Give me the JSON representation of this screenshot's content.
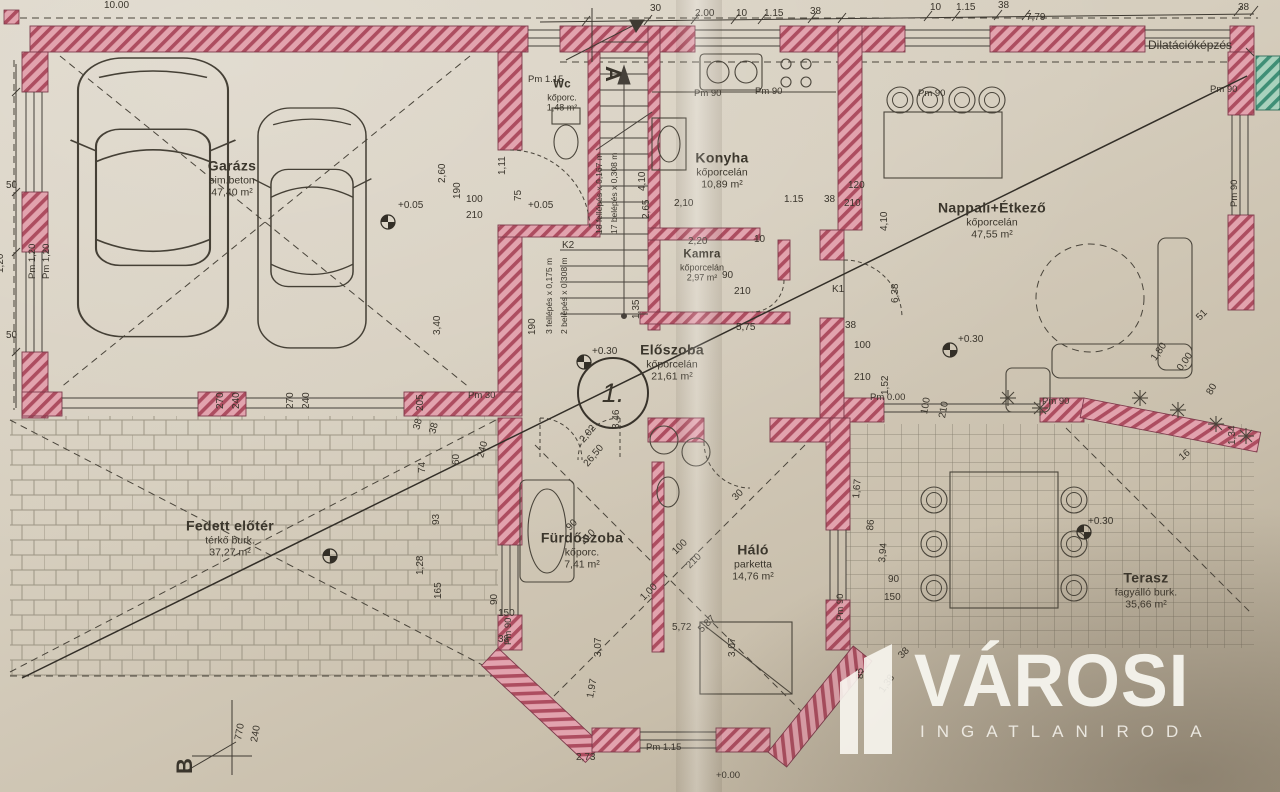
{
  "rooms": [
    {
      "name": "Garázs",
      "finish": "sim.beton",
      "area": "47,40 m²"
    },
    {
      "name": "Wc",
      "finish": "kőporc.",
      "area": "1,48 m²"
    },
    {
      "name": "Konyha",
      "finish": "kőporcelán",
      "area": "10,89 m²"
    },
    {
      "name": "Kamra",
      "finish": "kőporcelán",
      "area": "2,97 m²"
    },
    {
      "name": "Nappali+Étkező",
      "finish": "kőporcelán",
      "area": "47,55 m²"
    },
    {
      "name": "Előszoba",
      "finish": "kőporcelán",
      "area": "21,61 m²"
    },
    {
      "name": "Fürdőszoba",
      "finish": "kőporc.",
      "area": "7,41 m²"
    },
    {
      "name": "Háló",
      "finish": "parketta",
      "area": "14,76 m²"
    },
    {
      "name": "Terasz",
      "finish": "fagyálló burk.",
      "area": "35,66 m²"
    },
    {
      "name": "Fedett előtér",
      "finish": "térkő burk.",
      "area": "37,27 m²"
    }
  ],
  "markers": {
    "circle": "1.",
    "section_a": "A",
    "section_b": "B"
  },
  "watermark": {
    "title": "VÁROSI",
    "subtitle": "INGATLANIRODA"
  },
  "dims": [
    {
      "t": "10.00",
      "x": 104,
      "y": 0
    },
    {
      "t": "30",
      "x": 650,
      "y": 3
    },
    {
      "t": "2.00",
      "x": 695,
      "y": 8
    },
    {
      "t": "10",
      "x": 736,
      "y": 8
    },
    {
      "t": "1.15",
      "x": 764,
      "y": 8
    },
    {
      "t": "38",
      "x": 810,
      "y": 6
    },
    {
      "t": "10",
      "x": 930,
      "y": 2
    },
    {
      "t": "1.15",
      "x": 956,
      "y": 2
    },
    {
      "t": "38",
      "x": 998,
      "y": 0
    },
    {
      "t": "7,79",
      "x": 1026,
      "y": 12
    },
    {
      "t": "38",
      "x": 1238,
      "y": 2
    },
    {
      "t": "Dilatációképzés",
      "x": 1148,
      "y": 38,
      "c": "note"
    },
    {
      "t": "Pm 1.15",
      "x": 528,
      "y": 74,
      "c": "small"
    },
    {
      "t": "Pm 90",
      "x": 694,
      "y": 88,
      "c": "small"
    },
    {
      "t": "Pm 90",
      "x": 755,
      "y": 86,
      "c": "small"
    },
    {
      "t": "Pm 90",
      "x": 918,
      "y": 88,
      "c": "small"
    },
    {
      "t": "Pm 90",
      "x": 1210,
      "y": 84,
      "c": "small"
    },
    {
      "t": "Pm 90",
      "x": 1240,
      "y": 196,
      "r": -90,
      "c": "small"
    },
    {
      "t": "50",
      "x": 6,
      "y": 180
    },
    {
      "t": "Pm 1,20",
      "x": 38,
      "y": 268,
      "r": -90,
      "c": "small"
    },
    {
      "t": "Pm 1,20",
      "x": 52,
      "y": 268,
      "r": -90,
      "c": "small"
    },
    {
      "t": "50",
      "x": 6,
      "y": 330
    },
    {
      "t": "1,20",
      "x": 6,
      "y": 262,
      "r": -90
    },
    {
      "t": "270",
      "x": 226,
      "y": 398,
      "r": -90
    },
    {
      "t": "240",
      "x": 242,
      "y": 398,
      "r": -90
    },
    {
      "t": "270",
      "x": 296,
      "y": 398,
      "r": -90
    },
    {
      "t": "240",
      "x": 312,
      "y": 398,
      "r": -90
    },
    {
      "t": "+0.05",
      "x": 398,
      "y": 200
    },
    {
      "t": "100",
      "x": 466,
      "y": 194
    },
    {
      "t": "210",
      "x": 466,
      "y": 210
    },
    {
      "t": "2,60",
      "x": 448,
      "y": 172,
      "r": -90
    },
    {
      "t": "190",
      "x": 463,
      "y": 188,
      "r": -90
    },
    {
      "t": "3,40",
      "x": 443,
      "y": 324,
      "r": -90
    },
    {
      "t": "205",
      "x": 426,
      "y": 400,
      "r": -90
    },
    {
      "t": "Pm 30",
      "x": 468,
      "y": 390,
      "c": "small"
    },
    {
      "t": "+0.05",
      "x": 528,
      "y": 200
    },
    {
      "t": "1,11",
      "x": 508,
      "y": 164,
      "r": -90
    },
    {
      "t": "75",
      "x": 524,
      "y": 190,
      "r": -90
    },
    {
      "t": "190",
      "x": 538,
      "y": 324,
      "r": -90
    },
    {
      "t": "K2",
      "x": 562,
      "y": 240
    },
    {
      "t": "18 fellépés x 0,167 m",
      "x": 604,
      "y": 224,
      "r": -90,
      "c": "tiny"
    },
    {
      "t": "17 belépés x 0,308 m",
      "x": 619,
      "y": 224,
      "r": -90,
      "c": "tiny"
    },
    {
      "t": "3 fellépés x 0,175 m",
      "x": 554,
      "y": 324,
      "r": -90,
      "c": "tiny"
    },
    {
      "t": "2 belépés x 0,308 m",
      "x": 569,
      "y": 324,
      "r": -90,
      "c": "tiny"
    },
    {
      "t": "4,10",
      "x": 648,
      "y": 180,
      "r": -90
    },
    {
      "t": "2,65",
      "x": 652,
      "y": 208,
      "r": -90
    },
    {
      "t": "2,10",
      "x": 674,
      "y": 198
    },
    {
      "t": "1.15",
      "x": 784,
      "y": 194
    },
    {
      "t": "38",
      "x": 824,
      "y": 194
    },
    {
      "t": "210",
      "x": 844,
      "y": 198
    },
    {
      "t": "120",
      "x": 848,
      "y": 180
    },
    {
      "t": "2,20",
      "x": 688,
      "y": 236
    },
    {
      "t": "10",
      "x": 754,
      "y": 234
    },
    {
      "t": "1,35",
      "x": 642,
      "y": 308,
      "r": -90
    },
    {
      "t": "90",
      "x": 722,
      "y": 270
    },
    {
      "t": "210",
      "x": 734,
      "y": 286
    },
    {
      "t": "5,75",
      "x": 736,
      "y": 322
    },
    {
      "t": "+0.30",
      "x": 592,
      "y": 346
    },
    {
      "t": "3,46",
      "x": 622,
      "y": 418,
      "r": -90
    },
    {
      "t": "2,02",
      "x": 586,
      "y": 434,
      "r": -50
    },
    {
      "t": "26,50",
      "x": 590,
      "y": 458,
      "r": -50
    },
    {
      "t": "93",
      "x": 442,
      "y": 514,
      "r": -90
    },
    {
      "t": "74",
      "x": 428,
      "y": 462,
      "r": -90
    },
    {
      "t": "60",
      "x": 462,
      "y": 454,
      "r": -90
    },
    {
      "t": "240",
      "x": 486,
      "y": 448,
      "r": -75
    },
    {
      "t": "38",
      "x": 422,
      "y": 420,
      "r": -75
    },
    {
      "t": "38",
      "x": 438,
      "y": 424,
      "r": -75
    },
    {
      "t": "1,28",
      "x": 426,
      "y": 564,
      "r": -90
    },
    {
      "t": "165",
      "x": 444,
      "y": 588,
      "r": -90
    },
    {
      "t": "90",
      "x": 500,
      "y": 594,
      "r": -90
    },
    {
      "t": "150",
      "x": 498,
      "y": 608
    },
    {
      "t": "Pm 90",
      "x": 514,
      "y": 634,
      "r": -90,
      "c": "small"
    },
    {
      "t": "38",
      "x": 498,
      "y": 634
    },
    {
      "t": "4,10",
      "x": 890,
      "y": 220,
      "r": -90
    },
    {
      "t": "6,38",
      "x": 901,
      "y": 292,
      "r": -90
    },
    {
      "t": "38",
      "x": 845,
      "y": 320
    },
    {
      "t": "100",
      "x": 854,
      "y": 340
    },
    {
      "t": "210",
      "x": 854,
      "y": 372
    },
    {
      "t": "K1",
      "x": 832,
      "y": 284
    },
    {
      "t": "+0.30",
      "x": 958,
      "y": 334
    },
    {
      "t": "1,52",
      "x": 891,
      "y": 384,
      "r": -90
    },
    {
      "t": "Pm 0.00",
      "x": 870,
      "y": 392,
      "c": "small"
    },
    {
      "t": "100",
      "x": 930,
      "y": 404,
      "r": -80
    },
    {
      "t": "210",
      "x": 948,
      "y": 408,
      "r": -80
    },
    {
      "t": "Pm 90",
      "x": 1042,
      "y": 396,
      "c": "small"
    },
    {
      "t": "51",
      "x": 1202,
      "y": 312,
      "r": -45
    },
    {
      "t": "1,80",
      "x": 1158,
      "y": 352,
      "r": -55
    },
    {
      "t": "0,00",
      "x": 1184,
      "y": 362,
      "r": -55
    },
    {
      "t": "80",
      "x": 1214,
      "y": 386,
      "r": -60
    },
    {
      "t": "1,34",
      "x": 1238,
      "y": 434,
      "r": -90
    },
    {
      "t": "16",
      "x": 1184,
      "y": 452,
      "r": -40
    },
    {
      "t": "+0.30",
      "x": 1088,
      "y": 516
    },
    {
      "t": "1,67",
      "x": 862,
      "y": 488,
      "r": -85
    },
    {
      "t": "86",
      "x": 876,
      "y": 520,
      "r": -85
    },
    {
      "t": "3,94",
      "x": 888,
      "y": 552,
      "r": -85
    },
    {
      "t": "Pm 90",
      "x": 846,
      "y": 610,
      "r": -90,
      "c": "small"
    },
    {
      "t": "90",
      "x": 888,
      "y": 574
    },
    {
      "t": "150",
      "x": 884,
      "y": 592
    },
    {
      "t": "85",
      "x": 866,
      "y": 668,
      "r": -90
    },
    {
      "t": "38",
      "x": 904,
      "y": 650,
      "r": -45
    },
    {
      "t": "1,38",
      "x": 886,
      "y": 684,
      "r": -55
    },
    {
      "t": "90",
      "x": 572,
      "y": 522,
      "r": -45
    },
    {
      "t": "210",
      "x": 586,
      "y": 536,
      "r": -45
    },
    {
      "t": "100",
      "x": 678,
      "y": 546,
      "r": -45
    },
    {
      "t": "210",
      "x": 692,
      "y": 560,
      "r": -45
    },
    {
      "t": "1,00",
      "x": 646,
      "y": 592,
      "r": -45
    },
    {
      "t": "5,87",
      "x": 704,
      "y": 624,
      "r": -45
    },
    {
      "t": "30",
      "x": 738,
      "y": 492,
      "r": -45
    },
    {
      "t": "3,07",
      "x": 604,
      "y": 646,
      "r": -90
    },
    {
      "t": "1,97",
      "x": 596,
      "y": 688,
      "r": -80
    },
    {
      "t": "5,72",
      "x": 672,
      "y": 622
    },
    {
      "t": "3,07",
      "x": 738,
      "y": 646,
      "r": -90
    },
    {
      "t": "Pm 1.15",
      "x": 646,
      "y": 742,
      "c": "small"
    },
    {
      "t": "+0.00",
      "x": 716,
      "y": 770,
      "c": "small"
    },
    {
      "t": "2,73",
      "x": 576,
      "y": 752
    },
    {
      "t": "770",
      "x": 244,
      "y": 730,
      "r": -80
    },
    {
      "t": "240",
      "x": 260,
      "y": 732,
      "r": -80
    },
    {
      "t": "A",
      "x": 600,
      "y": 40,
      "r": 90,
      "c": "marker"
    },
    {
      "t": "B",
      "x": 198,
      "y": 748,
      "r": -90,
      "c": "marker"
    }
  ]
}
